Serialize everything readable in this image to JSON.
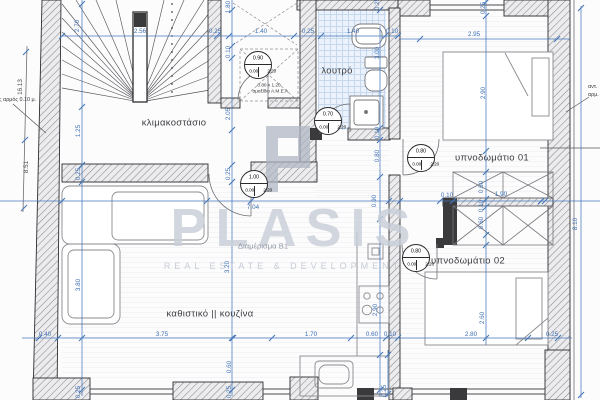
{
  "colors": {
    "dimension_blue": "#4577ba",
    "tile_blue": "#c5d8ee",
    "watermark_gray": "#c9cfd9",
    "wall_dark": "#3a3a3c"
  },
  "watermark": {
    "name": "PLASIS",
    "tagline": "REAL ESTATE & DEVELOPMENT"
  },
  "apartment_label": "Διαμέρισμα Β1",
  "annotations": {
    "amea_size": "0.80 x 1.20",
    "amea_label": "αμαξίδιο Α.Μ.Ε.Α.",
    "left_joint": "ς αρμός 0.10 μ.",
    "right_edge": [
      "αντ.",
      "αρμ."
    ]
  },
  "rooms": [
    {
      "name": "κλιμακοστάσιο",
      "x": 174,
      "y": 123
    },
    {
      "name": "λουτρό",
      "x": 337,
      "y": 71
    },
    {
      "name": "υπνοδωμάτιο 01",
      "x": 492,
      "y": 158
    },
    {
      "name": "υπνοδωμάτιο 02",
      "x": 468,
      "y": 261
    },
    {
      "name": "καθιστικό || κουζίνα",
      "x": 210,
      "y": 314
    }
  ],
  "door_tags": [
    {
      "w": "0.90",
      "sill": "0.00",
      "head": "2.20",
      "x": 257,
      "y": 64
    },
    {
      "w": "0.70",
      "sill": "0.00",
      "head": "2.20",
      "x": 327,
      "y": 120
    },
    {
      "w": "1.00",
      "sill": "0.00",
      "head": "2.20",
      "x": 253,
      "y": 183
    },
    {
      "w": "0.80",
      "sill": "0.00",
      "head": "2.20",
      "x": 420,
      "y": 157
    },
    {
      "w": "0.80",
      "sill": "0.00",
      "head": "2.20",
      "x": 415,
      "y": 257
    }
  ],
  "dimensions": [
    {
      "t": "2.56",
      "x": 140,
      "y": 31,
      "r": 0
    },
    {
      "t": "0.25",
      "x": 215,
      "y": 31,
      "r": 0
    },
    {
      "t": "1.40",
      "x": 261,
      "y": 31,
      "r": 0
    },
    {
      "t": "0.25",
      "x": 308,
      "y": 31,
      "r": 0
    },
    {
      "t": "1.40",
      "x": 353,
      "y": 31,
      "r": 0
    },
    {
      "t": "0.10",
      "x": 392,
      "y": 31,
      "r": 0
    },
    {
      "t": "2.95",
      "x": 474,
      "y": 34,
      "r": 0
    },
    {
      "t": "2.70",
      "x": 77,
      "y": 26,
      "r": 1
    },
    {
      "t": "1.25",
      "x": 78,
      "y": 131,
      "r": 1
    },
    {
      "t": "0.25",
      "x": 78,
      "y": 174,
      "r": 1
    },
    {
      "t": "3.80",
      "x": 78,
      "y": 285,
      "r": 1
    },
    {
      "t": "0.25",
      "x": 78,
      "y": 392,
      "r": 1
    },
    {
      "t": "1.80",
      "x": 228,
      "y": 7,
      "r": 1
    },
    {
      "t": "0.10",
      "x": 228,
      "y": 52,
      "r": 1
    },
    {
      "t": "2.05",
      "x": 228,
      "y": 114,
      "r": 1
    },
    {
      "t": "0.25",
      "x": 228,
      "y": 174,
      "r": 1
    },
    {
      "t": "3.20",
      "x": 227,
      "y": 267,
      "r": 1
    },
    {
      "t": "0.60",
      "x": 229,
      "y": 367,
      "r": 1
    },
    {
      "t": "0.25",
      "x": 229,
      "y": 392,
      "r": 1
    },
    {
      "t": "0.25",
      "x": 377,
      "y": 4,
      "r": 1
    },
    {
      "t": "3.00",
      "x": 377,
      "y": 53,
      "r": 1
    },
    {
      "t": "0.10",
      "x": 377,
      "y": 133,
      "r": 1
    },
    {
      "t": "0.80",
      "x": 377,
      "y": 156,
      "r": 1
    },
    {
      "t": "0.90",
      "x": 374,
      "y": 201,
      "r": 1
    },
    {
      "t": "2.90",
      "x": 375,
      "y": 310,
      "r": 1
    },
    {
      "t": "0.25",
      "x": 384,
      "y": 391,
      "r": 1
    },
    {
      "t": "0.25",
      "x": 483,
      "y": 8,
      "r": 1
    },
    {
      "t": "2.90",
      "x": 483,
      "y": 93,
      "r": 1
    },
    {
      "t": "0.60",
      "x": 481,
      "y": 187,
      "r": 1
    },
    {
      "t": "0.10",
      "x": 481,
      "y": 206,
      "r": 1
    },
    {
      "t": "0.60",
      "x": 481,
      "y": 223,
      "r": 1
    },
    {
      "t": "2.60",
      "x": 482,
      "y": 318,
      "r": 1
    },
    {
      "t": "0.10",
      "x": 447,
      "y": 195,
      "r": 0
    },
    {
      "t": "1.90",
      "x": 501,
      "y": 194,
      "r": 0
    },
    {
      "t": "7.04",
      "x": 253,
      "y": 207,
      "r": 0
    },
    {
      "t": "0.40",
      "x": 45,
      "y": 334,
      "r": 0
    },
    {
      "t": "3.75",
      "x": 162,
      "y": 334,
      "r": 0
    },
    {
      "t": "1.70",
      "x": 311,
      "y": 334,
      "r": 0
    },
    {
      "t": "0.60",
      "x": 372,
      "y": 334,
      "r": 0
    },
    {
      "t": "0.10",
      "x": 390,
      "y": 334,
      "r": 0
    },
    {
      "t": "2.80",
      "x": 471,
      "y": 334,
      "r": 0
    },
    {
      "t": "0.25",
      "x": 552,
      "y": 334,
      "r": 0
    },
    {
      "t": "16.13",
      "x": 20,
      "y": 87,
      "r": 1,
      "d": 1
    },
    {
      "t": "8.51",
      "x": 26,
      "y": 167,
      "r": 1,
      "d": 1
    },
    {
      "t": "8.10",
      "x": 575,
      "y": 224,
      "r": 1
    }
  ]
}
